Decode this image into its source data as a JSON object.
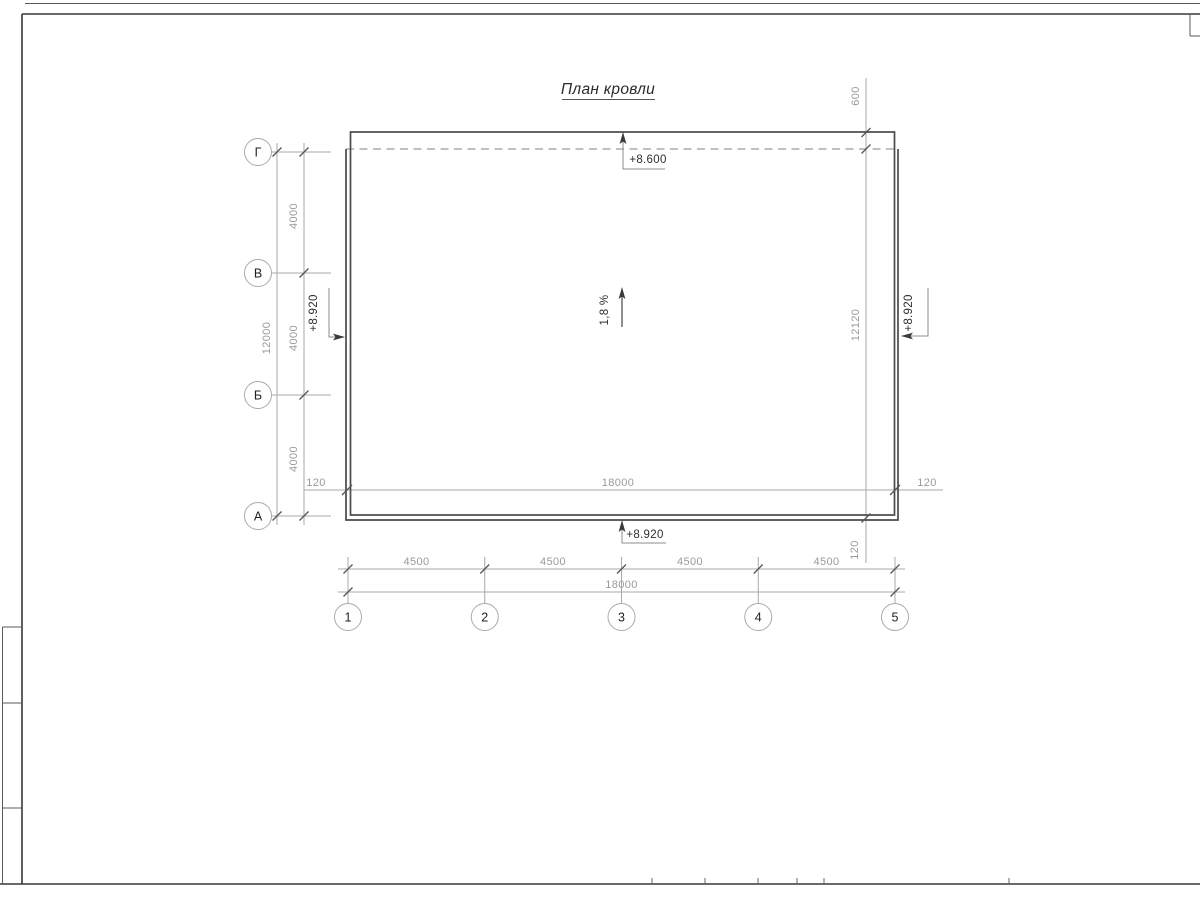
{
  "sheet": {
    "title": "План кровли"
  },
  "axes": {
    "rows": [
      "Г",
      "В",
      "Б",
      "А"
    ],
    "columns": [
      "1",
      "2",
      "3",
      "4",
      "5"
    ]
  },
  "dimensions": {
    "row_spacings": [
      "4000",
      "4000",
      "4000"
    ],
    "rows_total": "12000",
    "column_spacings": [
      "4500",
      "4500",
      "4500",
      "4500"
    ],
    "columns_total": "18000",
    "roof_width": "18000",
    "overhang_left": "120",
    "overhang_right": "120",
    "overhang_bottom": "120",
    "parapet_top": "600",
    "roof_depth": "12120"
  },
  "marks": {
    "elevation_top": "+8.600",
    "elevation_left": "+8.920",
    "elevation_right": "+8.920",
    "elevation_bottom": "+8.920",
    "slope": "1,8 %"
  },
  "colors": {
    "background": "#ffffff",
    "outline": "#4a4a4a",
    "dimension_line": "#a9a9a9",
    "dimension_text": "#9a9a9a",
    "annotation_text": "#2e2e2e",
    "frame": "#383838"
  }
}
